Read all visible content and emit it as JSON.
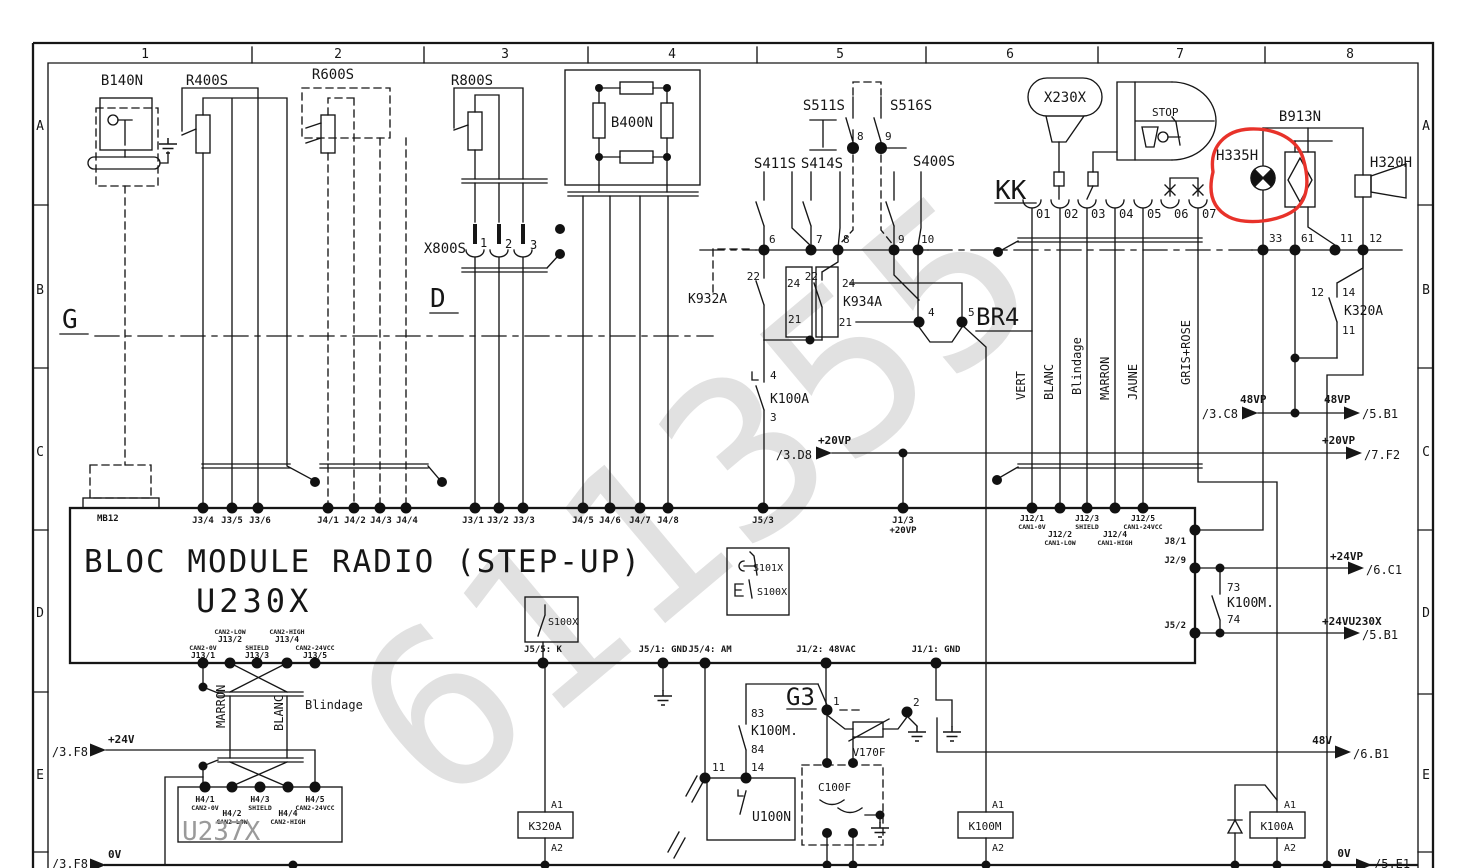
{
  "watermark": "611355",
  "colors": {
    "line": "#161616",
    "annotation": "#e8322a",
    "watermark": "#dcdcdc"
  },
  "frame": {
    "cols": [
      "1",
      "2",
      "3",
      "4",
      "5",
      "6",
      "7",
      "8"
    ],
    "rowsL": [
      "A",
      "B",
      "C",
      "D",
      "E"
    ],
    "rowsR": [
      "A",
      "B",
      "C",
      "D",
      "E"
    ]
  },
  "t": {
    "b140n": "B140N",
    "r400s": "R400S",
    "r600s": "R600S",
    "r800s": "R800S",
    "b400n": "B400N",
    "x800s": "X800S",
    "x1": "1",
    "x2": "2",
    "x3": "3",
    "g": "G",
    "d": "D",
    "s411s": "S411S",
    "s414s": "S414S",
    "s511s": "S511S",
    "s516s": "S516S",
    "s400s": "S400S",
    "p6": "6",
    "p7": "7",
    "p8": "8",
    "p8b": "8",
    "p9": "9",
    "p9b": "9",
    "p10": "10",
    "k932a": "K932A",
    "k934a": "K934A",
    "p22a": "22",
    "p24a": "24",
    "p21a": "21",
    "p22b": "22",
    "p24b": "24",
    "p21b": "21",
    "k100a": "K100A",
    "p4a": "4",
    "p3a": "3",
    "br4": "BR4",
    "p4": "4",
    "p5": "5",
    "d8ref": "/3.D8",
    "d8net": "+20VP",
    "x230x": "X230X",
    "stop": "STOP",
    "kk": "KK",
    "k01": "01",
    "k02": "02",
    "k03": "03",
    "k04": "04",
    "k05": "05",
    "k06": "06",
    "k07": "07",
    "h335h": "H335H",
    "b913n": "B913N",
    "h320h": "H320H",
    "p33": "33",
    "p61": "61",
    "p11": "11",
    "p12": "12",
    "k320a": "K320A",
    "p12b": "12",
    "p14": "14",
    "p11b": "11",
    "vert": "VERT",
    "blanc": "BLANC",
    "blind": "Blindage",
    "marron": "MARRON",
    "jaune": "JAUNE",
    "gris": "GRIS+ROSE",
    "c8ref": "/3.C8",
    "c8net": "48VP",
    "b1ref": "/5.B1",
    "b1net": "48VP",
    "f2ref": "/7.F2",
    "f2net": "+20VP",
    "c1ref": "/6.C1",
    "c1net": "+24VP",
    "b1bref": "/5.B1",
    "b1bnet": "+24VU230X",
    "b6ref": "/6.B1",
    "b6net": "48V",
    "e1ref": "/5.E1",
    "e1net": "0V",
    "f8ref": "/3.F8",
    "f8net": "+24V",
    "f8bref": "/3.F8",
    "f8bnet": "0V",
    "mb12": "MB12",
    "bloc": "BLOC MODULE RADIO (STEP-UP)",
    "u230x": "U230X",
    "j34": "J3/4",
    "j35": "J3/5",
    "j36": "J3/6",
    "j41": "J4/1",
    "j42": "J4/2",
    "j43": "J4/3",
    "j44": "J4/4",
    "j31": "J3/1",
    "j32": "J3/2",
    "j33": "J3/3",
    "j45": "J4/5",
    "j46": "J4/6",
    "j47": "J4/7",
    "j48": "J4/8",
    "j53": "J5/3",
    "j13": "J1/3",
    "j13net": "+20VP",
    "j121": "J12/1",
    "j121n": "CAN1-0V",
    "j122": "J12/2",
    "j122n": "CAN1-LOW",
    "j123": "J12/3",
    "j123n": "SHIELD",
    "j124": "J12/4",
    "j124n": "CAN1-HIGH",
    "j125": "J12/5",
    "j125n": "CAN1-24VCC",
    "j81": "J8/1",
    "j29": "J2/9",
    "j52": "J5/2",
    "p73": "73",
    "p74": "74",
    "k100mc": "K100M.",
    "s101x": "S101X",
    "s100x": "S100X",
    "s100xb": "S100X",
    "j55": "J5/5: K",
    "j51": "J5/1: GND",
    "j54": "J5/4: AM",
    "j12v": "J1/2: 48VAC",
    "j11v": "J1/1: GND",
    "j131": "J13/1",
    "j131n": "CAN2-0V",
    "j132": "J13/2",
    "j132n": "CAN2-LOW",
    "j133": "J13/3",
    "j133n": "SHIELD",
    "j134": "J13/4",
    "j134n": "CAN2-HIGH",
    "j135": "J13/5",
    "j135n": "CAN2-24VCC",
    "blind2": "Blindage",
    "marron2": "MARRON",
    "blanc2": "BLANC",
    "u237x": "U237X",
    "h41": "H4/1",
    "h41n": "CAN2-0V",
    "h42": "H4/2",
    "h42n": "CAN2-LOW",
    "h43": "H4/3",
    "h43n": "SHIELD",
    "h44": "H4/4",
    "h44n": "CAN2-HIGH",
    "h45": "H4/5",
    "h45n": "CAN2-24VCC",
    "k320ac": "K320A",
    "a1a": "A1",
    "a2a": "A2",
    "p11c": "11",
    "p14b": "14",
    "u100n": "U100N",
    "p83": "83",
    "p84": "84",
    "k100mc2": "K100M.",
    "g3": "G3",
    "p1": "1",
    "p2": "2",
    "v170f": "V170F",
    "c100f": "C100F",
    "k100m": "K100M",
    "a1b": "A1",
    "a2b": "A2",
    "k100acoil": "K100A",
    "a1c": "A1",
    "a2c": "A2"
  }
}
